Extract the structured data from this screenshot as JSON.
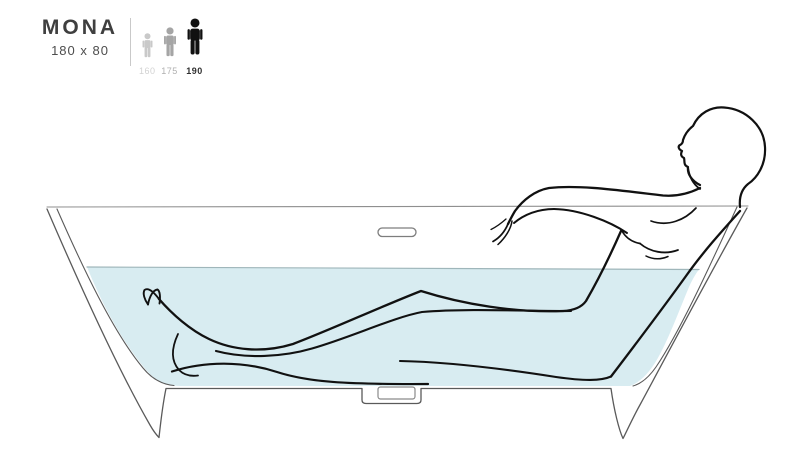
{
  "product": {
    "name": "MONA",
    "size": "180 x 80"
  },
  "height_legend": {
    "options": [
      {
        "label": "160",
        "selected": false
      },
      {
        "label": "175",
        "selected": false
      },
      {
        "label": "190",
        "selected": true
      }
    ]
  },
  "illustration": {
    "description": "Side-view line drawing of a person reclining in a freestanding bathtub filled with water, head resting on the back rim and arm stretched along the edge"
  },
  "colors": {
    "water": "#d8ecf1",
    "water_surface_line": "#9fb6ba",
    "tub_outline": "#5a5a5a",
    "rim_line": "#8f8f8f",
    "figure_line": "#111111",
    "person_icon_160": "#c9c9c9",
    "person_icon_175": "#a5a5a5",
    "person_icon_190": "#111111"
  }
}
